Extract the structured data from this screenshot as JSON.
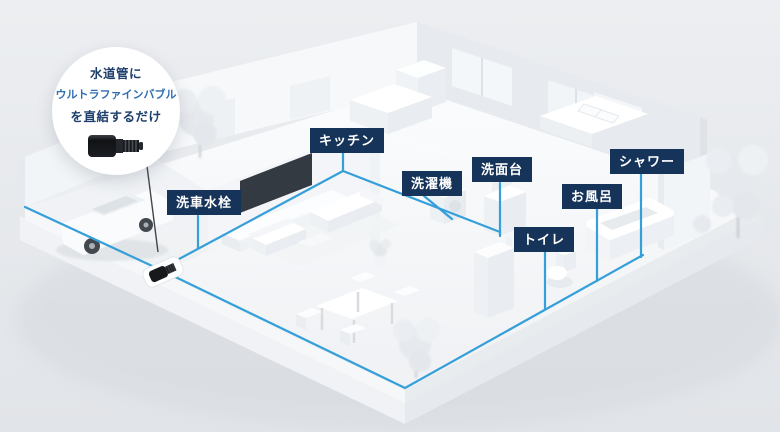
{
  "illustration": {
    "callout": {
      "line1": "水道管に",
      "line2": "ウルトラファインバブル",
      "line3": "を直結するだけ"
    },
    "labels": {
      "car_wash_faucet": "洗車水栓",
      "kitchen": "キッチン",
      "washing_machine": "洗濯機",
      "washbasin": "洗面台",
      "toilet": "トイレ",
      "bath": "お風呂",
      "shower": "シャワー"
    },
    "icons": {
      "callout_device": "ultrafine-bubble-unit-icon",
      "pipe_device": "ultrafine-bubble-unit-icon"
    },
    "colors": {
      "background": "#e7e9ec",
      "pipe_blue": "#359fd9",
      "label_bg": "#163459",
      "label_text": "#ffffff",
      "callout_text_dark": "#1e3f6b",
      "callout_text_blue": "#2e6fb3"
    }
  }
}
